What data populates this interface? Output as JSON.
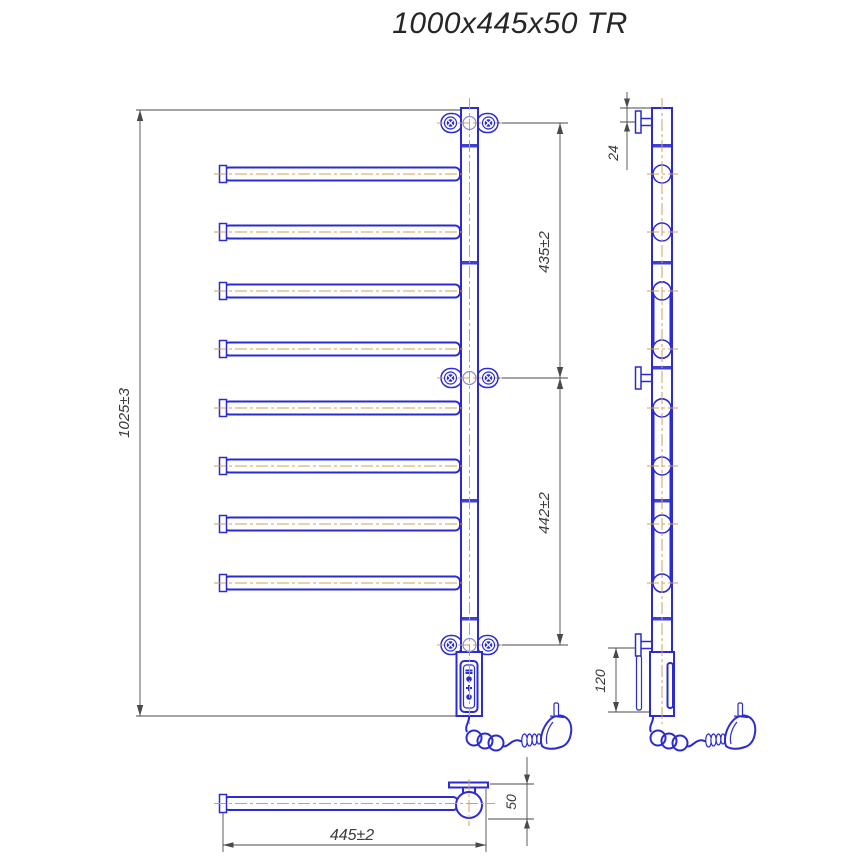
{
  "title": "1000x445x50 TR",
  "drawing_type": "heated-towel-rail-technical-drawing",
  "dims": {
    "height_overall": "1025±3",
    "span_upper": "435±2",
    "span_lower": "442±2",
    "top_offset": "24",
    "bottom_offset": "120",
    "width_overall": "445±2",
    "depth": "50"
  },
  "colors": {
    "outline": "#2b2bd0",
    "centerline": "#d2a05f",
    "dimension_lines": "#4a4a4a",
    "background": "#ffffff"
  },
  "views": {
    "front": "front view with 8 swivel bars",
    "side": "side profile with wall brackets",
    "bottom": "top/plan view of single bar"
  }
}
